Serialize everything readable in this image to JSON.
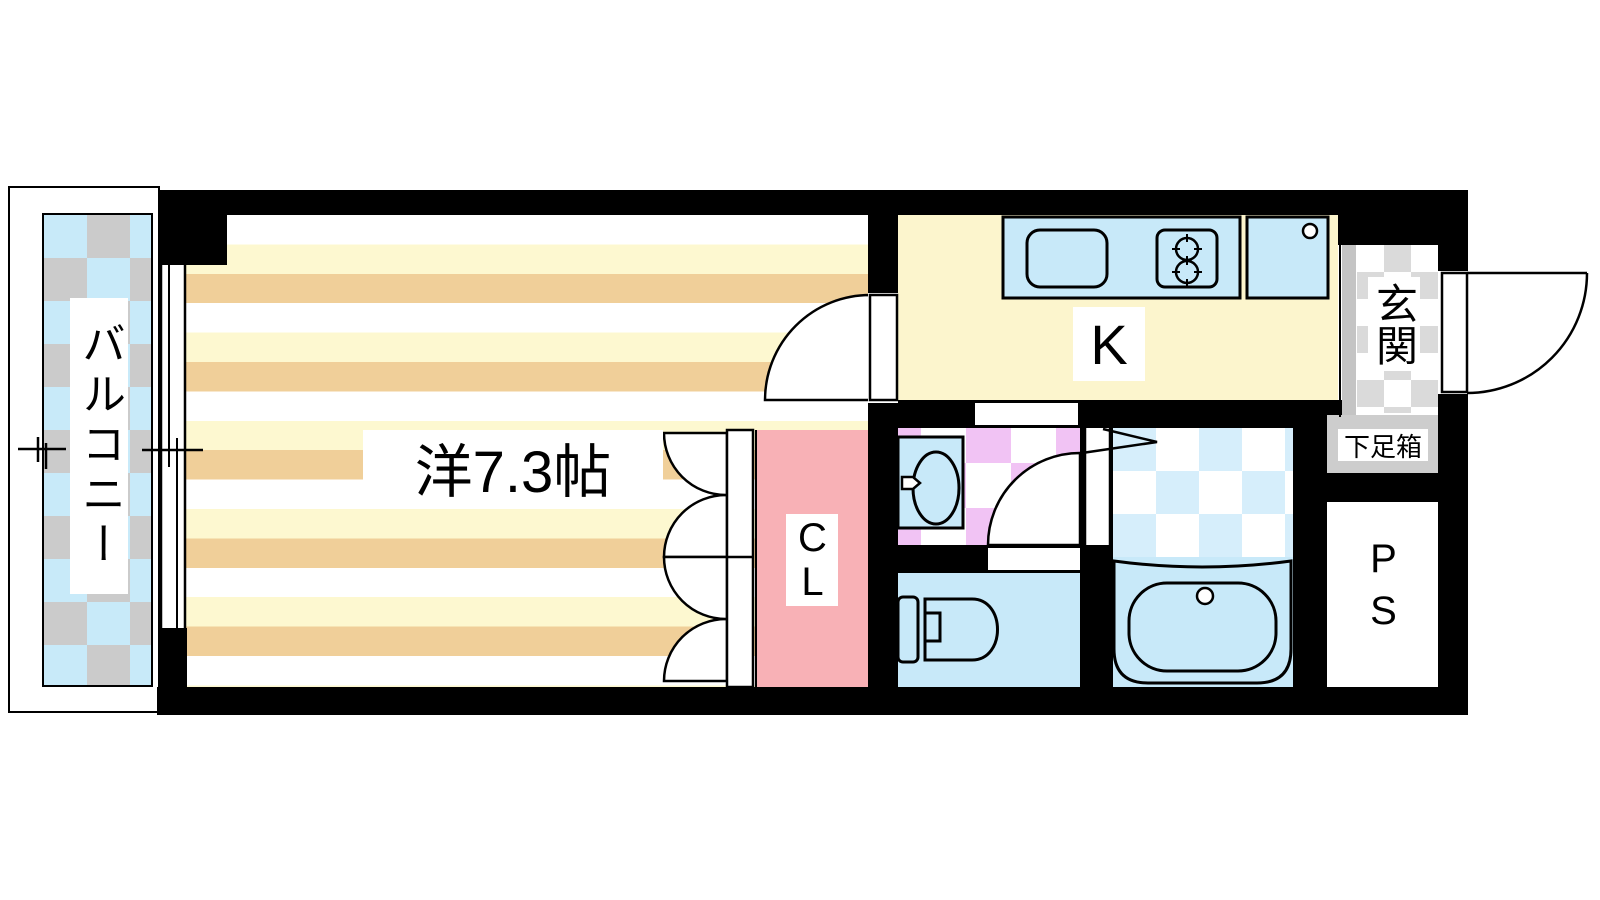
{
  "title": "apartment-floor-plan",
  "labels": {
    "balcony": "バルコニー",
    "main_room": "洋7.3帖",
    "kitchen": "K",
    "closet": "CL",
    "entrance": "玄関",
    "shoe_box": "下足箱",
    "pipe_space": "PS"
  },
  "icons": {
    "kitchen_sink": "sink-icon",
    "stove": "two-burner-stove-icon",
    "appliance": "appliance-space-icon",
    "washbasin": "washbasin-icon",
    "toilet": "toilet-icon",
    "bathtub": "bathtub-icon",
    "closet_door": "folding-door-icon",
    "room_door": "door-swing-icon",
    "toilet_door": "door-swing-icon",
    "entrance_door": "entrance-door-swing-icon",
    "window": "sliding-window-icon",
    "bath_entry": "direction-arrow-icon"
  },
  "colors": {
    "wall": "#000000",
    "stripe_yellow": "#fdf8d0",
    "stripe_tan": "#f0cf99",
    "kitchen_floor": "#fcf5cd",
    "fixture_blue": "#c8e9f9",
    "bath_tile_blue": "#d6eefb",
    "closet_pink": "#f8b1b6",
    "washroom_tile_purple": "#f1c3f4",
    "balcony_blue": "#c8eaf9",
    "balcony_gray": "#cbcbcb",
    "entrance_gray": "#dadada",
    "step_gray": "#c4c4c4",
    "shoebox_gray": "#cdcdcd"
  }
}
